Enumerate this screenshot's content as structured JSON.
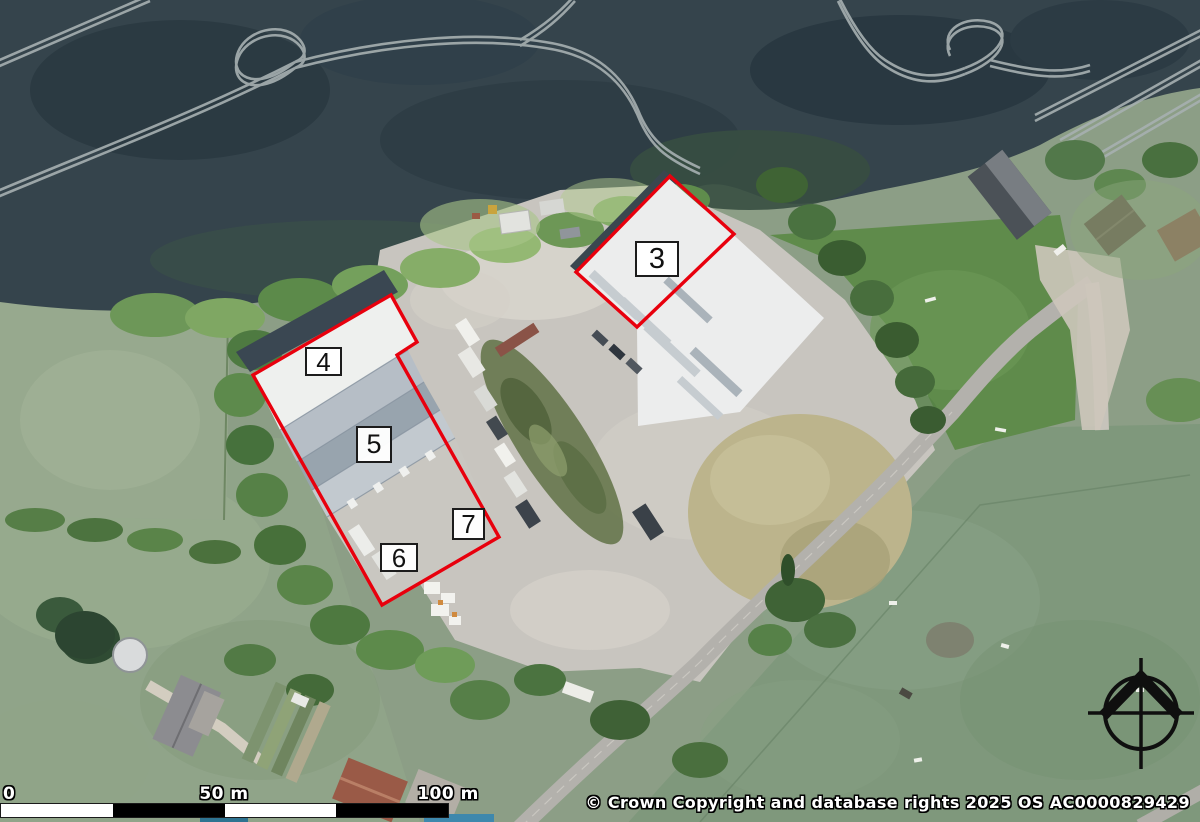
{
  "map": {
    "description": "Aerial site plan with outlined plots",
    "annotations": {
      "outline_color": "#e8000d",
      "label_border_color": "#1c1c1c",
      "labels": [
        {
          "text": "3"
        },
        {
          "text": "4"
        },
        {
          "text": "5"
        },
        {
          "text": "6"
        },
        {
          "text": "7"
        }
      ],
      "polygons": [
        {
          "name": "plot-3-outline",
          "points": "670,176 734,234 637,327 576,272"
        },
        {
          "name": "plots-4-7-outline",
          "points": "391,295 417,342 397,355 499,537 382,605 253,375"
        }
      ]
    },
    "scale_bar": {
      "labels": [
        "0",
        "50 m",
        "100 m"
      ]
    },
    "copyright": "© Crown Copyright and database rights 2025 OS AC0000829429",
    "icons": {
      "north_arrow": "compass-north-arrow"
    }
  }
}
